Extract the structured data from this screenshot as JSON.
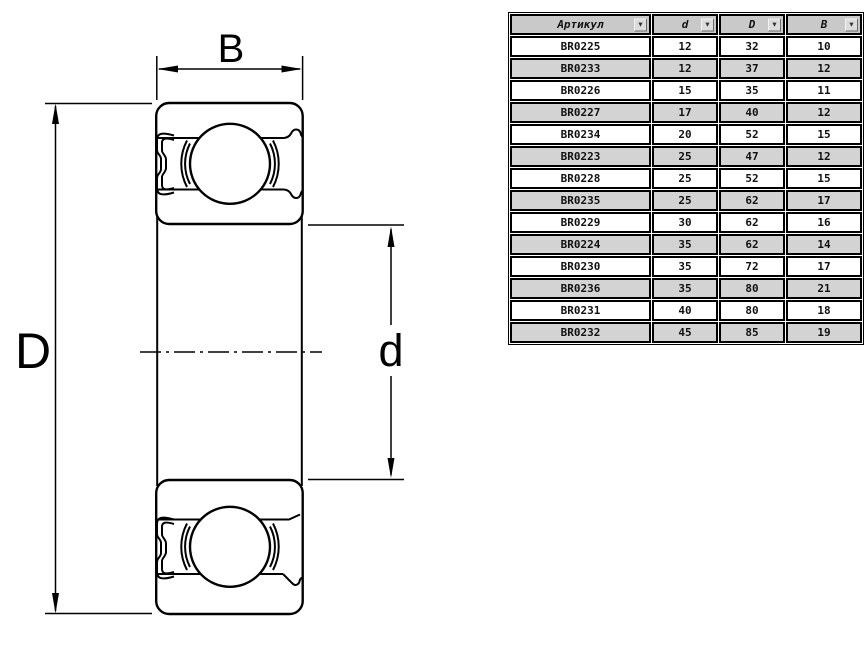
{
  "page": {
    "background": "#ffffff"
  },
  "diagram": {
    "type": "bearing-cross-section",
    "stroke_color": "#000000",
    "dim_labels": {
      "width": "B",
      "outer_diameter": "D",
      "inner_diameter": "d"
    }
  },
  "table": {
    "filter_icon": "▼",
    "colors": {
      "header_bg": "#c9c9c9",
      "row_bg": "#ffffff",
      "row_alt_bg": "#d3d3d3",
      "border": "#000000"
    },
    "columns": [
      {
        "key": "article",
        "label": "Артикул"
      },
      {
        "key": "d",
        "label": "d"
      },
      {
        "key": "D",
        "label": "D"
      },
      {
        "key": "B",
        "label": "B"
      }
    ],
    "rows": [
      {
        "article": "BR0225",
        "d": "12",
        "D": "32",
        "B": "10"
      },
      {
        "article": "BR0233",
        "d": "12",
        "D": "37",
        "B": "12"
      },
      {
        "article": "BR0226",
        "d": "15",
        "D": "35",
        "B": "11"
      },
      {
        "article": "BR0227",
        "d": "17",
        "D": "40",
        "B": "12"
      },
      {
        "article": "BR0234",
        "d": "20",
        "D": "52",
        "B": "15"
      },
      {
        "article": "BR0223",
        "d": "25",
        "D": "47",
        "B": "12"
      },
      {
        "article": "BR0228",
        "d": "25",
        "D": "52",
        "B": "15"
      },
      {
        "article": "BR0235",
        "d": "25",
        "D": "62",
        "B": "17"
      },
      {
        "article": "BR0229",
        "d": "30",
        "D": "62",
        "B": "16"
      },
      {
        "article": "BR0224",
        "d": "35",
        "D": "62",
        "B": "14"
      },
      {
        "article": "BR0230",
        "d": "35",
        "D": "72",
        "B": "17"
      },
      {
        "article": "BR0236",
        "d": "35",
        "D": "80",
        "B": "21"
      },
      {
        "article": "BR0231",
        "d": "40",
        "D": "80",
        "B": "18"
      },
      {
        "article": "BR0232",
        "d": "45",
        "D": "85",
        "B": "19"
      }
    ]
  }
}
